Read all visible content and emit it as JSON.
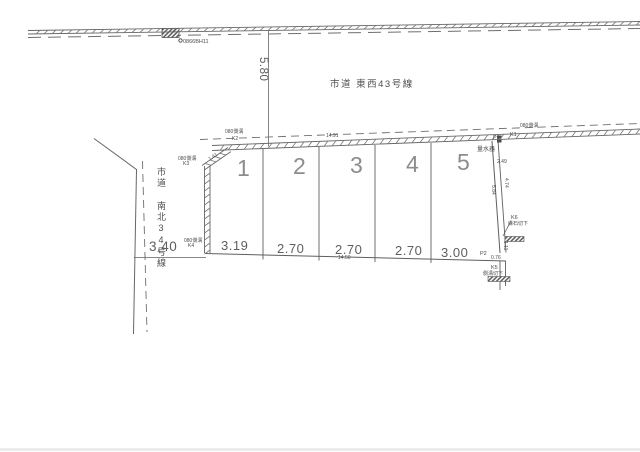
{
  "roads": {
    "top": {
      "name": "市道 東西43号線"
    },
    "left": {
      "name": "市道 南北34号線"
    }
  },
  "benchmark": {
    "id": "0866BH11"
  },
  "dims": {
    "setback": "5.80",
    "left_offset": "3.40",
    "top_total": "14.91",
    "bottom_total": "14.50",
    "chamfer": "1.41",
    "right_top": "2.49",
    "right_a": "5.84",
    "right_b": "4.74",
    "right_c": "1.11",
    "p2_offset": "0.76"
  },
  "parcels": [
    {
      "no": "1",
      "width": "3.19"
    },
    {
      "no": "2",
      "width": "2.70"
    },
    {
      "no": "3",
      "width": "2.70"
    },
    {
      "no": "4",
      "width": "2.70"
    },
    {
      "no": "5",
      "width": "3.00"
    }
  ],
  "points": {
    "k1": "K1",
    "k2": "K2",
    "k3": "K3",
    "k4": "K4",
    "k5": "K5",
    "k6": "K6",
    "p1": "P1",
    "p2": "P2"
  },
  "labels": {
    "gutter": "080側溝",
    "water_meter": "量水器",
    "k6_note": "縁石切下",
    "k5_note": "側溝切下"
  },
  "colors": {
    "line": "#5f5f5f",
    "text": "#555555"
  }
}
